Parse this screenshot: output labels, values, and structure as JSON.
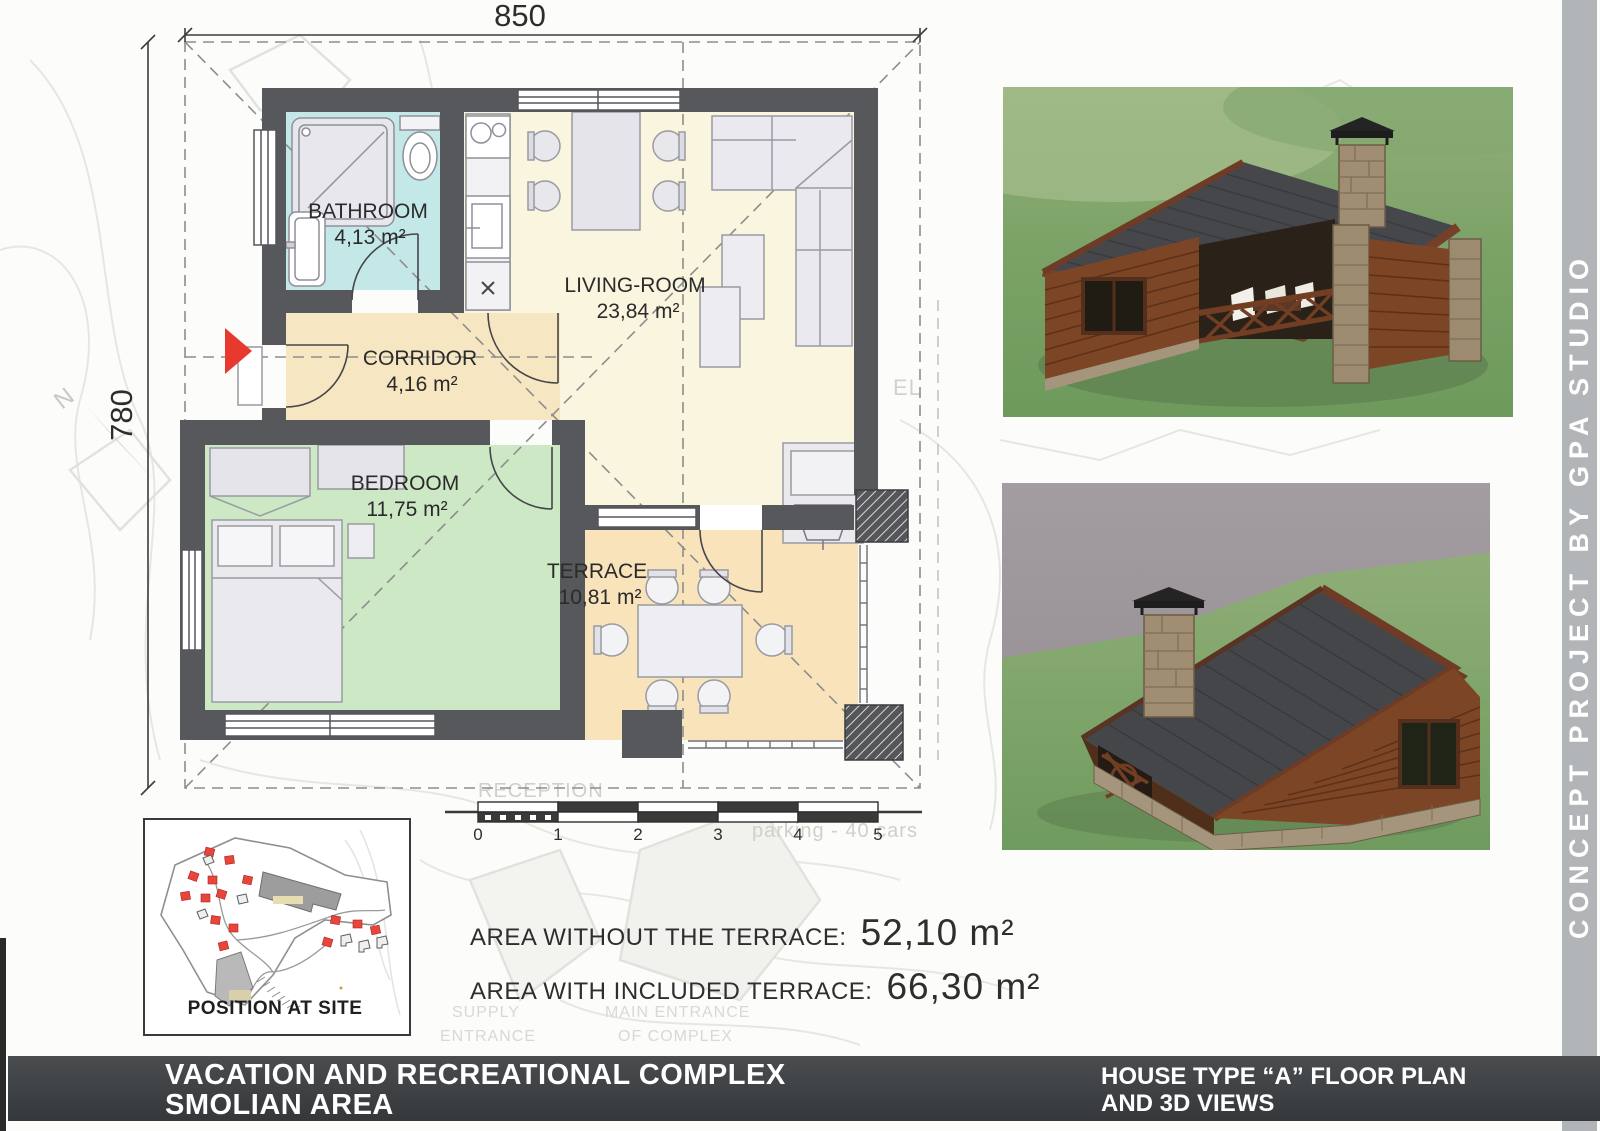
{
  "plan": {
    "dim_top": "850",
    "dim_left": "780",
    "north_label": "N",
    "rooms": {
      "bathroom": {
        "name": "BATHROOM",
        "area": "4,13 m²"
      },
      "corridor": {
        "name": "CORRIDOR",
        "area": "4,16 m²"
      },
      "living": {
        "name": "LIVING-ROOM",
        "area": "23,84 m²"
      },
      "bedroom": {
        "name": "BEDROOM",
        "area": "11,75 m²"
      },
      "terrace": {
        "name": "TERRACE",
        "area": "10,81 m²"
      }
    }
  },
  "scalebar": {
    "ticks": [
      "0",
      "1",
      "2",
      "3",
      "4",
      "5"
    ]
  },
  "areas": {
    "line1_label": "AREA WITHOUT THE TERRACE:",
    "line1_value": "52,10 m²",
    "line2_label": "AREA WITH INCLUDED TERRACE:",
    "line2_value": "66,30 m²"
  },
  "site_inset": {
    "caption": "POSITION AT SITE"
  },
  "watermarks": {
    "reception": "RECEPTION",
    "restaurant": "RESTAURANT",
    "parking": "parking - 40 cars",
    "supply_line1": "SUPPLY",
    "supply_line2": "ENTRANCE",
    "main_line1": "MAIN ENTRANCE",
    "main_line2": "OF COMPLEX",
    "hotel_fragment": "EL"
  },
  "footer": {
    "left_line1": "VACATION AND RECREATIONAL COMPLEX",
    "left_line2": "SMOLIAN AREA",
    "right_line1": "HOUSE TYPE “A”  FLOOR PLAN",
    "right_line2": "AND 3D VIEWS"
  },
  "side_strip": {
    "text": "CONCEPT PROJECT BY GPA STUDIO"
  }
}
